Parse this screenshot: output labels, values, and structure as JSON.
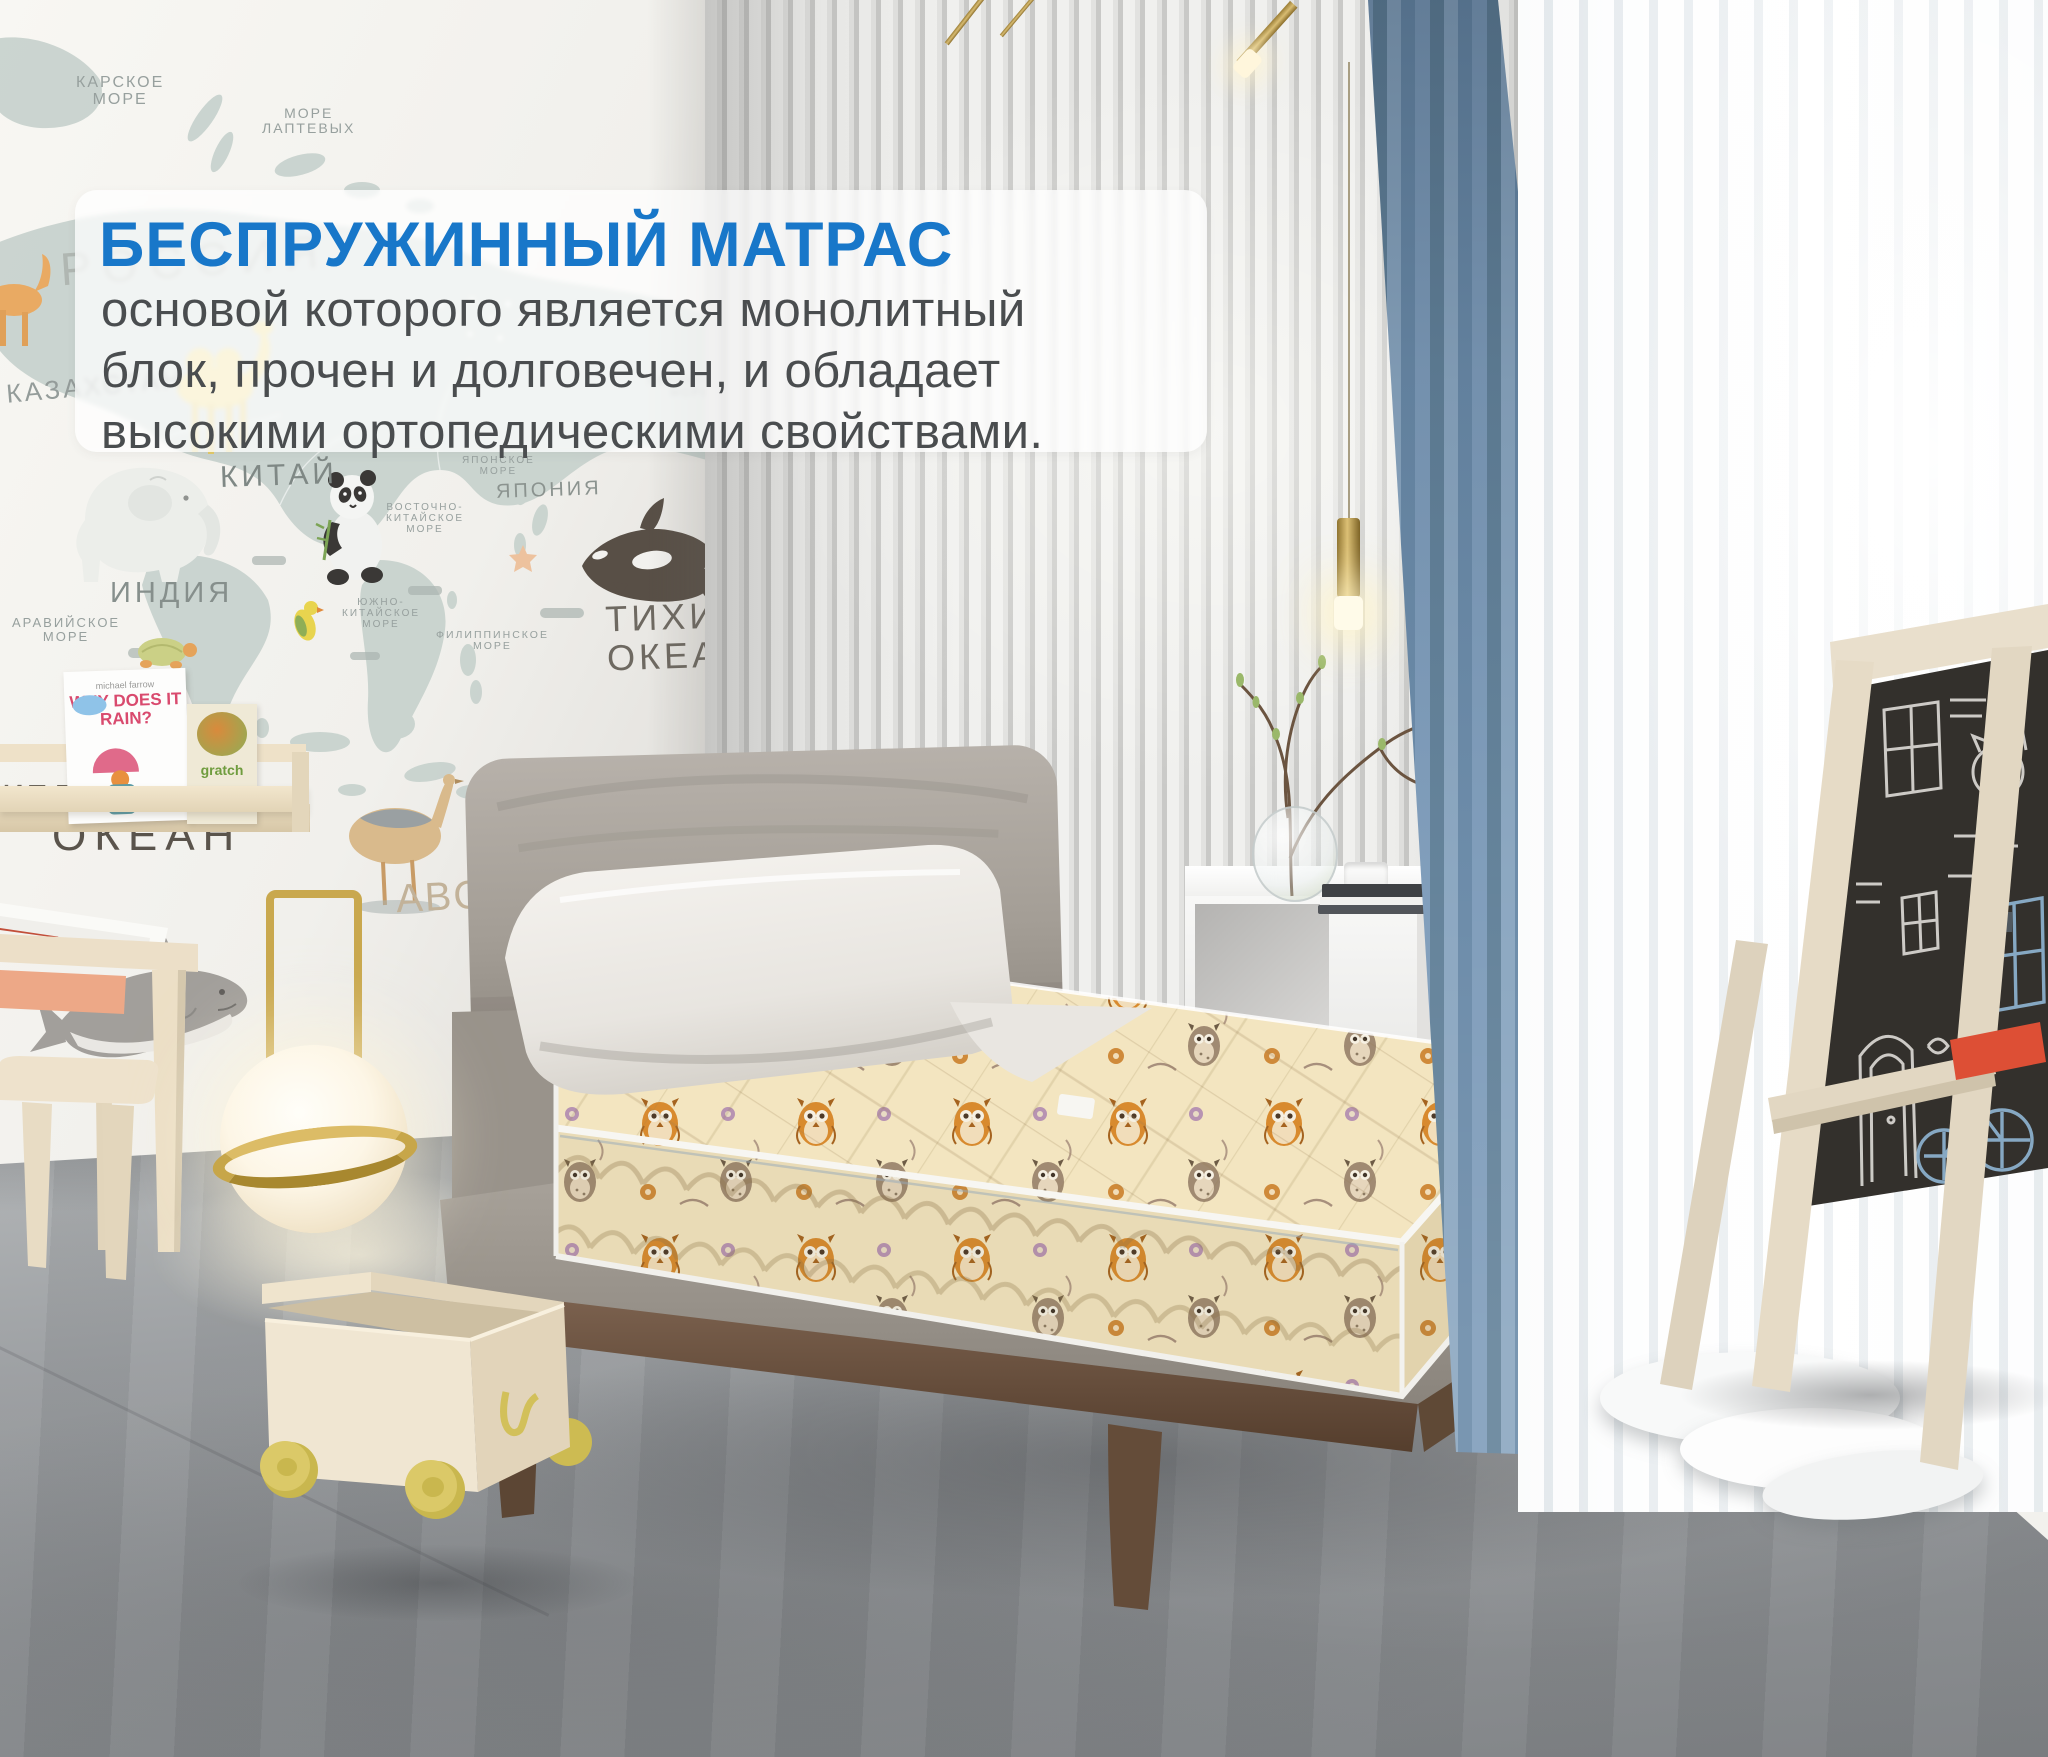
{
  "overlay": {
    "title": "БЕСПРУЖИННЫЙ МАТРАС",
    "title_color": "#1877c9",
    "text_color": "#4a4d4f",
    "lines": [
      "основой которого является монолитный",
      "блок, прочен и долговечен, и обладает",
      "высокими ортопедическими свойствами."
    ]
  },
  "map_labels": [
    {
      "name": "kara-sea",
      "text": "КАРСКОЕ\nМОРЕ"
    },
    {
      "name": "laptev-sea",
      "text": "МОРЕ\nЛАПТЕВЫХ"
    },
    {
      "name": "russia",
      "text": "РОССИЯ"
    },
    {
      "name": "kazakhstan",
      "text": "КАЗАХСТАН"
    },
    {
      "name": "china",
      "text": "КИТАЙ"
    },
    {
      "name": "india",
      "text": "ИНДИЯ"
    },
    {
      "name": "arabian-sea",
      "text": "АРАВИЙСКОЕ\nМОРЕ"
    },
    {
      "name": "bering-sea",
      "text": "БЕРИНГОВО\nМОРЕ"
    },
    {
      "name": "japan-sea",
      "text": "ЯПОНСКОЕ\nМОРЕ"
    },
    {
      "name": "east-china-sea",
      "text": "ВОСТОЧНО-\nКИТАЙСКОЕ\nМОРЕ"
    },
    {
      "name": "japan",
      "text": "ЯПОНИЯ"
    },
    {
      "name": "south-china-sea",
      "text": "ЮЖНО-\nКИТАЙСКОЕ\nМОРЕ"
    },
    {
      "name": "philippine-sea",
      "text": "ФИЛИППИНСКОЕ\nМОРЕ"
    },
    {
      "name": "pacific-ocean",
      "text": "ТИХИЙ\nОКЕАН"
    },
    {
      "name": "indian-ocean-fragment",
      "text": "ипд"
    },
    {
      "name": "ocean",
      "text": "ОКЕАН"
    },
    {
      "name": "alphabet",
      "text": "ABC"
    }
  ],
  "bookshelf": {
    "book1_author": "michael farrow",
    "book1_title": "WHY DOES IT RAIN?",
    "book2_title": "gratch"
  },
  "palette": {
    "accent_blue": "#1877c9",
    "curtain_blue": "#6e8fae",
    "mattress_cream": "#f3e5c0",
    "owl_orange": "#d88a2e",
    "wood_walnut": "#6a523f",
    "toy_wheel_yellow": "#d9c75e",
    "headboard_gray": "#a39d95",
    "floor_gray": "#94979a"
  }
}
